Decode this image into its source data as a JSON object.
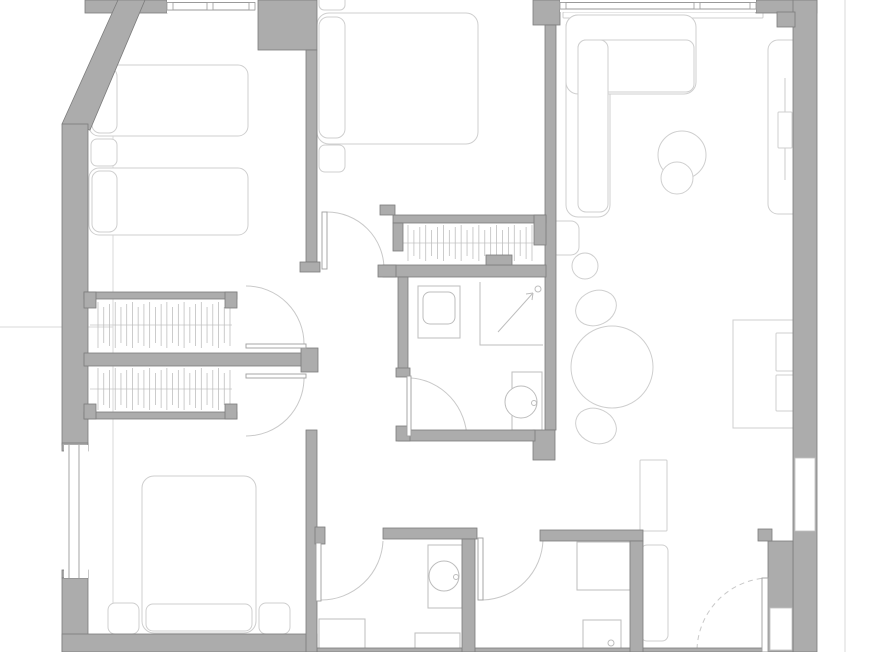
{
  "canvas": {
    "width": 870,
    "height": 652,
    "background": "#ffffff"
  },
  "colors": {
    "wall_fill": "#acacac",
    "wall_stroke": "#7c7c7c",
    "furniture": "#cfcfcf",
    "fixture": "#bdbdbd",
    "arcline": "#c9c9c9",
    "leafline": "#9e9e9e",
    "nicheline": "#c2c2c2",
    "refline": "#dadada",
    "winline": "#9a9a9a",
    "tick": "#bfbfbf",
    "rail": "#c6c6c6"
  },
  "layers": {
    "refs": [
      {
        "name": "ref-line-left",
        "type": "line",
        "x1": 113,
        "y1": 0,
        "x2": 113,
        "y2": 652
      },
      {
        "name": "ref-line-right",
        "type": "line",
        "x1": 845,
        "y1": 0,
        "x2": 845,
        "y2": 652
      },
      {
        "name": "ref-line-mid-left",
        "type": "line",
        "x1": 0,
        "y1": 327,
        "x2": 113,
        "y2": 327
      }
    ],
    "furniture": [
      {
        "name": "bed-1a",
        "type": "rect",
        "x": 89,
        "y": 65,
        "w": 159,
        "h": 71,
        "r": 10
      },
      {
        "name": "bed-1a-pillow",
        "type": "rect",
        "x": 92,
        "y": 68,
        "w": 25,
        "h": 65,
        "r": 8
      },
      {
        "name": "nightstand-bed1",
        "type": "rect",
        "x": 91,
        "y": 139,
        "w": 26,
        "h": 27,
        "r": 6
      },
      {
        "name": "bed-1b",
        "type": "rect",
        "x": 89,
        "y": 168,
        "w": 159,
        "h": 67,
        "r": 10
      },
      {
        "name": "bed-1b-pillow",
        "type": "rect",
        "x": 92,
        "y": 171,
        "w": 25,
        "h": 61,
        "r": 8
      },
      {
        "name": "bed-2",
        "type": "rect",
        "x": 317,
        "y": 13,
        "w": 161,
        "h": 131,
        "r": 12
      },
      {
        "name": "bed-2-pillow-top",
        "type": "rect",
        "x": 319,
        "y": -6,
        "w": 26,
        "h": 16,
        "r": 5
      },
      {
        "name": "bed-2-pillow",
        "type": "rect",
        "x": 319,
        "y": 17,
        "w": 26,
        "h": 121,
        "r": 9
      },
      {
        "name": "bed-2-cushion",
        "type": "rect",
        "x": 319,
        "y": 145,
        "w": 26,
        "h": 27,
        "r": 6
      },
      {
        "name": "bed-3",
        "type": "rect",
        "x": 142,
        "y": 476,
        "w": 114,
        "h": 157,
        "r": 12
      },
      {
        "name": "bed-3-pillow",
        "type": "rect",
        "x": 146,
        "y": 604,
        "w": 106,
        "h": 27,
        "r": 7
      },
      {
        "name": "nightstand-bed3-left",
        "type": "rect",
        "x": 108,
        "y": 603,
        "w": 31,
        "h": 31,
        "r": 7
      },
      {
        "name": "nightstand-bed3-right",
        "type": "rect",
        "x": 259,
        "y": 603,
        "w": 31,
        "h": 31,
        "r": 7
      },
      {
        "name": "sofa-sill",
        "type": "rect",
        "x": 563,
        "y": 12,
        "w": 200,
        "h": 6,
        "r": 1
      },
      {
        "name": "sofa-chaise",
        "type": "rect",
        "x": 566,
        "y": 15,
        "w": 44,
        "h": 202,
        "r": 12
      },
      {
        "name": "sofa-main",
        "type": "rect",
        "x": 566,
        "y": 15,
        "w": 130,
        "h": 79,
        "r": 12
      },
      {
        "name": "sofa-seat",
        "type": "rect",
        "x": 578,
        "y": 40,
        "w": 116,
        "h": 52,
        "r": 8
      },
      {
        "name": "sofa-chaise-seat",
        "type": "rect",
        "x": 578,
        "y": 40,
        "w": 30,
        "h": 172,
        "r": 8
      },
      {
        "name": "side-table-large",
        "type": "circle",
        "cx": 682,
        "cy": 155,
        "rr": 24
      },
      {
        "name": "side-table-small",
        "type": "circle",
        "cx": 677,
        "cy": 178,
        "rr": 16
      },
      {
        "name": "tall-unit",
        "type": "rect",
        "x": 768,
        "y": 40,
        "w": 34,
        "h": 174,
        "r": 10
      },
      {
        "name": "tall-unit-line",
        "type": "line",
        "x1": 785,
        "y1": 78,
        "x2": 785,
        "y2": 180
      },
      {
        "name": "tall-unit-box",
        "type": "rect",
        "x": 778,
        "y": 112,
        "w": 14,
        "h": 36,
        "r": 1
      },
      {
        "name": "floor-lamp",
        "type": "circle",
        "cx": 585,
        "cy": 266,
        "rr": 13
      },
      {
        "name": "armchair",
        "type": "rect",
        "x": 549,
        "y": 221,
        "w": 30,
        "h": 34,
        "r": 8
      },
      {
        "name": "desk",
        "type": "rect",
        "x": 733,
        "y": 320,
        "w": 68,
        "h": 108,
        "r": 0
      },
      {
        "name": "desk-chair-top",
        "type": "rect",
        "x": 776,
        "y": 333,
        "w": 22,
        "h": 38,
        "r": 1
      },
      {
        "name": "desk-chair-bottom",
        "type": "rect",
        "x": 776,
        "y": 375,
        "w": 22,
        "h": 36,
        "r": 1
      },
      {
        "name": "dining-chair-top",
        "type": "ellipse",
        "cx": 596,
        "cy": 308,
        "rx": 21,
        "ry": 17,
        "rot": -25
      },
      {
        "name": "dining-chair-bottom",
        "type": "ellipse",
        "cx": 596,
        "cy": 426,
        "rx": 21,
        "ry": 17,
        "rot": 25
      },
      {
        "name": "dining-table",
        "type": "circle",
        "cx": 612,
        "cy": 367,
        "rr": 41
      },
      {
        "name": "entry-cabinet",
        "type": "rect",
        "x": 640,
        "y": 460,
        "w": 27,
        "h": 71,
        "r": 1
      },
      {
        "name": "entry-closet",
        "type": "rect",
        "x": 641,
        "y": 545,
        "w": 27,
        "h": 96,
        "r": 6
      }
    ],
    "fixtures": [
      {
        "name": "bath1-basin-cabinet",
        "type": "rect",
        "x": 418,
        "y": 286,
        "w": 42,
        "h": 52,
        "r": 0
      },
      {
        "name": "bath1-basin",
        "type": "rect",
        "x": 423,
        "y": 292,
        "w": 32,
        "h": 32,
        "r": 7
      },
      {
        "name": "bath1-shower-edge",
        "type": "path",
        "d": "M480,282 L480,345 L543,345"
      },
      {
        "name": "bath1-shower-arrow",
        "type": "line",
        "x1": 498,
        "y1": 332,
        "x2": 533,
        "y2": 293
      },
      {
        "name": "bath1-shower-arrow-b1",
        "type": "line",
        "x1": 533,
        "y1": 293,
        "x2": 526,
        "y2": 294
      },
      {
        "name": "bath1-shower-arrow-b2",
        "type": "line",
        "x1": 533,
        "y1": 293,
        "x2": 532,
        "y2": 300
      },
      {
        "name": "bath1-shower-head",
        "type": "circle",
        "cx": 538,
        "cy": 289,
        "rr": 3
      },
      {
        "name": "bath1-toilet-tank",
        "type": "rect",
        "x": 512,
        "y": 372,
        "w": 30,
        "h": 58,
        "r": 0
      },
      {
        "name": "bath1-toilet-bowl",
        "type": "circle",
        "cx": 521,
        "cy": 402,
        "rr": 16
      },
      {
        "name": "bath1-toilet-button",
        "type": "circle",
        "cx": 534,
        "cy": 403,
        "rr": 2.5
      },
      {
        "name": "wc-washstand",
        "type": "rect",
        "x": 428,
        "y": 545,
        "w": 34,
        "h": 63,
        "r": 0
      },
      {
        "name": "wc-toilet-bowl",
        "type": "circle",
        "cx": 444,
        "cy": 576,
        "rr": 15
      },
      {
        "name": "wc-toilet-button",
        "type": "circle",
        "cx": 456,
        "cy": 577,
        "rr": 2.5
      },
      {
        "name": "wc-sink",
        "type": "rect",
        "x": 415,
        "y": 633,
        "w": 45,
        "h": 19,
        "r": 0
      },
      {
        "name": "wc-tray",
        "type": "rect",
        "x": 319,
        "y": 619,
        "w": 46,
        "h": 33,
        "r": 0
      },
      {
        "name": "bath2-shower",
        "type": "rect",
        "x": 577,
        "y": 542,
        "w": 53,
        "h": 48,
        "r": 0
      },
      {
        "name": "bath2-basin",
        "type": "rect",
        "x": 583,
        "y": 620,
        "w": 38,
        "h": 32,
        "r": 0
      },
      {
        "name": "bath2-basin-drain",
        "type": "circle",
        "cx": 611,
        "cy": 643,
        "rr": 3
      }
    ],
    "hangrails": [
      {
        "name": "wardrobe-rail-upper",
        "type": "hangrail",
        "x1": 98,
        "x2": 230,
        "railY": 325,
        "t1": 302,
        "t2": 348,
        "n": 24
      },
      {
        "name": "wardrobe-rail-lower",
        "type": "hangrail",
        "x1": 98,
        "x2": 230,
        "railY": 389,
        "t1": 368,
        "t2": 410,
        "n": 24
      },
      {
        "name": "closet-rail-center",
        "type": "hangrail",
        "x1": 408,
        "x2": 532,
        "railY": 243,
        "t1": 225,
        "t2": 261,
        "n": 22
      }
    ],
    "arcs": [
      {
        "name": "door-arc-bedroom2",
        "type": "path",
        "d": "M327,212 A57,57 0 0 1 384,269"
      },
      {
        "name": "door-arc-bedroom1",
        "type": "path",
        "d": "M304,344 A58,58 0 0 0 246,286"
      },
      {
        "name": "door-arc-bedroom3",
        "type": "path",
        "d": "M304,378 A58,58 0 0 1 246,436"
      },
      {
        "name": "door-arc-bath1",
        "type": "path",
        "d": "M411,378 A60,62 0 0 1 467,439"
      },
      {
        "name": "door-arc-wc",
        "type": "path",
        "d": "M321,600 A62,62 0 0 0 383,541"
      },
      {
        "name": "door-arc-bath2",
        "type": "path",
        "d": "M483,600 A62,62 0 0 0 543,540"
      },
      {
        "name": "door-arc-entry",
        "type": "path",
        "d": "M697,649 A74,74 0 0 1 766,578",
        "dashed": true
      }
    ],
    "walls": [
      {
        "name": "wall-top-left",
        "type": "rect",
        "x": 85,
        "y": 0,
        "w": 82,
        "h": 13
      },
      {
        "name": "wall-corner-block-bed12",
        "type": "rect",
        "x": 258,
        "y": 0,
        "w": 59,
        "h": 50
      },
      {
        "name": "wall-divider-bed12",
        "type": "rect",
        "x": 306,
        "y": 50,
        "w": 11,
        "h": 212
      },
      {
        "name": "wall-divider-bed12-cap",
        "type": "rect",
        "x": 300,
        "y": 262,
        "w": 20,
        "h": 10
      },
      {
        "name": "wall-left-diagonal",
        "type": "polygon",
        "pts": "62,124 118,0 145,0 90,130"
      },
      {
        "name": "wall-left",
        "type": "rect",
        "x": 62,
        "y": 124,
        "w": 26,
        "h": 321
      },
      {
        "name": "wall-window-cap-top",
        "type": "rect",
        "x": 62,
        "y": 443,
        "w": 26,
        "h": 8
      },
      {
        "name": "wall-window-cap-bottom",
        "type": "rect",
        "x": 62,
        "y": 570,
        "w": 26,
        "h": 8
      },
      {
        "name": "wall-window-mullion-left",
        "type": "rect",
        "x": 66,
        "y": 519,
        "w": 16,
        "h": 8
      },
      {
        "name": "wall-left-lower",
        "type": "rect",
        "x": 62,
        "y": 578,
        "w": 26,
        "h": 74
      },
      {
        "name": "wall-bottom-bed3",
        "type": "rect",
        "x": 62,
        "y": 634,
        "w": 255,
        "h": 18
      },
      {
        "name": "wall-bottom-sliver",
        "type": "rect",
        "x": 317,
        "y": 648,
        "w": 476,
        "h": 4
      },
      {
        "name": "wall-top-block-mid",
        "type": "rect",
        "x": 533,
        "y": 0,
        "w": 27,
        "h": 25
      },
      {
        "name": "wall-living-divider",
        "type": "rect",
        "x": 545,
        "y": 25,
        "w": 11,
        "h": 405
      },
      {
        "name": "wall-living-corner",
        "type": "rect",
        "x": 533,
        "y": 430,
        "w": 22,
        "h": 30
      },
      {
        "name": "wall-top-right",
        "type": "rect",
        "x": 756,
        "y": 0,
        "w": 61,
        "h": 13
      },
      {
        "name": "wall-right",
        "type": "rect",
        "x": 793,
        "y": 0,
        "w": 24,
        "h": 652
      },
      {
        "name": "wall-right-step",
        "type": "rect",
        "x": 777,
        "y": 12,
        "w": 18,
        "h": 15
      },
      {
        "name": "wall-right-entry",
        "type": "rect",
        "x": 768,
        "y": 541,
        "w": 25,
        "h": 111
      },
      {
        "name": "wall-entry-jamb",
        "type": "rect",
        "x": 758,
        "y": 529,
        "w": 14,
        "h": 12
      },
      {
        "name": "wall-closet-top",
        "type": "rect",
        "x": 393,
        "y": 215,
        "w": 153,
        "h": 8
      },
      {
        "name": "wall-closet-left-cap",
        "type": "rect",
        "x": 393,
        "y": 223,
        "w": 10,
        "h": 28
      },
      {
        "name": "wall-closet-right-cap",
        "type": "rect",
        "x": 534,
        "y": 215,
        "w": 12,
        "h": 30
      },
      {
        "name": "wall-closet-bottom",
        "type": "rect",
        "x": 383,
        "y": 265,
        "w": 163,
        "h": 12
      },
      {
        "name": "wall-closet-notch",
        "type": "rect",
        "x": 486,
        "y": 255,
        "w": 26,
        "h": 10
      },
      {
        "name": "wall-closet-foot",
        "type": "rect",
        "x": 378,
        "y": 265,
        "w": 18,
        "h": 12
      },
      {
        "name": "wall-passage-stub",
        "type": "rect",
        "x": 380,
        "y": 205,
        "w": 15,
        "h": 10
      },
      {
        "name": "wall-bath1-left",
        "type": "rect",
        "x": 398,
        "y": 277,
        "w": 10,
        "h": 93
      },
      {
        "name": "wall-bath1-left-cap",
        "type": "rect",
        "x": 396,
        "y": 368,
        "w": 14,
        "h": 9
      },
      {
        "name": "wall-bath1-bottom",
        "type": "rect",
        "x": 398,
        "y": 430,
        "w": 137,
        "h": 11
      },
      {
        "name": "wall-bath1-bottom-cap",
        "type": "rect",
        "x": 396,
        "y": 426,
        "w": 14,
        "h": 15
      },
      {
        "name": "wall-wardrobe-top",
        "type": "rect",
        "x": 84,
        "y": 292,
        "w": 153,
        "h": 7
      },
      {
        "name": "wall-wardrobe-top-cap-left",
        "type": "rect",
        "x": 84,
        "y": 292,
        "w": 12,
        "h": 16
      },
      {
        "name": "wall-wardrobe-top-cap-right",
        "type": "rect",
        "x": 225,
        "y": 292,
        "w": 12,
        "h": 16
      },
      {
        "name": "wall-wardrobe-mid",
        "type": "rect",
        "x": 84,
        "y": 353,
        "w": 219,
        "h": 13
      },
      {
        "name": "wall-wardrobe-mid-cap",
        "type": "rect",
        "x": 301,
        "y": 348,
        "w": 17,
        "h": 24
      },
      {
        "name": "wall-wardrobe-bottom",
        "type": "rect",
        "x": 84,
        "y": 412,
        "w": 153,
        "h": 7
      },
      {
        "name": "wall-wardrobe-bottom-cap-left",
        "type": "rect",
        "x": 84,
        "y": 404,
        "w": 12,
        "h": 15
      },
      {
        "name": "wall-wardrobe-bottom-cap-right",
        "type": "rect",
        "x": 225,
        "y": 404,
        "w": 12,
        "h": 15
      },
      {
        "name": "wall-bed3-hall",
        "type": "rect",
        "x": 306,
        "y": 430,
        "w": 11,
        "h": 222
      },
      {
        "name": "wall-wc-jamb",
        "type": "rect",
        "x": 315,
        "y": 527,
        "w": 10,
        "h": 17
      },
      {
        "name": "wall-corridor-left",
        "type": "rect",
        "x": 383,
        "y": 528,
        "w": 94,
        "h": 11
      },
      {
        "name": "wall-corridor-right",
        "type": "rect",
        "x": 540,
        "y": 530,
        "w": 103,
        "h": 11
      },
      {
        "name": "wall-wc-right",
        "type": "rect",
        "x": 462,
        "y": 539,
        "w": 13,
        "h": 113
      },
      {
        "name": "wall-bath2-right",
        "type": "rect",
        "x": 630,
        "y": 541,
        "w": 13,
        "h": 111
      }
    ],
    "niches": [
      {
        "name": "wall-niche-upper",
        "type": "rect",
        "x": 795,
        "y": 458,
        "w": 20,
        "h": 73
      },
      {
        "name": "wall-niche-lower",
        "type": "rect",
        "x": 770,
        "y": 608,
        "w": 22,
        "h": 42
      }
    ],
    "windows": [
      {
        "name": "window-bedroom1",
        "type": "window",
        "dir": "h",
        "x": 167,
        "y": 0,
        "w": 88,
        "h": 13,
        "mullions": [
          167,
          207,
          249
        ]
      },
      {
        "name": "window-living",
        "type": "window",
        "dir": "h",
        "x": 560,
        "y": 0,
        "w": 196,
        "h": 12,
        "mullions": [
          560,
          694,
          750
        ]
      },
      {
        "name": "window-bedroom3",
        "type": "window",
        "dir": "v",
        "x": 64,
        "y": 445,
        "w": 24,
        "h": 133,
        "mullions": []
      }
    ],
    "leaves": [
      {
        "name": "door-leaf-bedroom2",
        "type": "rect",
        "x": 322,
        "y": 212,
        "w": 5,
        "h": 57
      },
      {
        "name": "door-leaf-bedroom1",
        "type": "rect",
        "x": 246,
        "y": 344,
        "w": 60,
        "h": 4
      },
      {
        "name": "door-leaf-bedroom3",
        "type": "rect",
        "x": 246,
        "y": 374,
        "w": 60,
        "h": 4
      },
      {
        "name": "door-leaf-bath1",
        "type": "rect",
        "x": 407,
        "y": 376,
        "w": 4,
        "h": 60
      },
      {
        "name": "door-leaf-wc",
        "type": "rect",
        "x": 316,
        "y": 543,
        "w": 5,
        "h": 58
      },
      {
        "name": "door-leaf-bath2",
        "type": "rect",
        "x": 478,
        "y": 538,
        "w": 5,
        "h": 62
      },
      {
        "name": "door-leaf-entry",
        "type": "rect",
        "x": 762,
        "y": 578,
        "w": 6,
        "h": 74
      }
    ]
  }
}
